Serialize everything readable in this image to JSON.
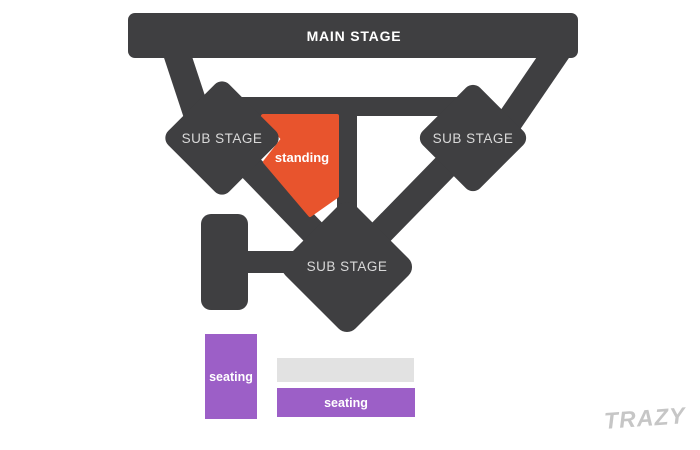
{
  "colors": {
    "structure_dark": "#3f3f41",
    "standing_orange": "#e8542d",
    "seating_purple": "#9c5fc7",
    "block_gray": "#e2e2e2",
    "label_white": "#ffffff",
    "substage_label_gray": "#d9d9d9",
    "watermark_gray": "#c6c6c6",
    "background": "#ffffff"
  },
  "stage": {
    "label": "MAIN STAGE"
  },
  "sub_stages": {
    "left": "SUB STAGE",
    "right": "SUB STAGE",
    "center": "SUB STAGE"
  },
  "zones": {
    "standing": {
      "label": "standing"
    },
    "seating_left": {
      "label": "seating"
    },
    "seating_bottom": {
      "label": "seating"
    }
  },
  "watermark": {
    "text": "TRAZY"
  }
}
